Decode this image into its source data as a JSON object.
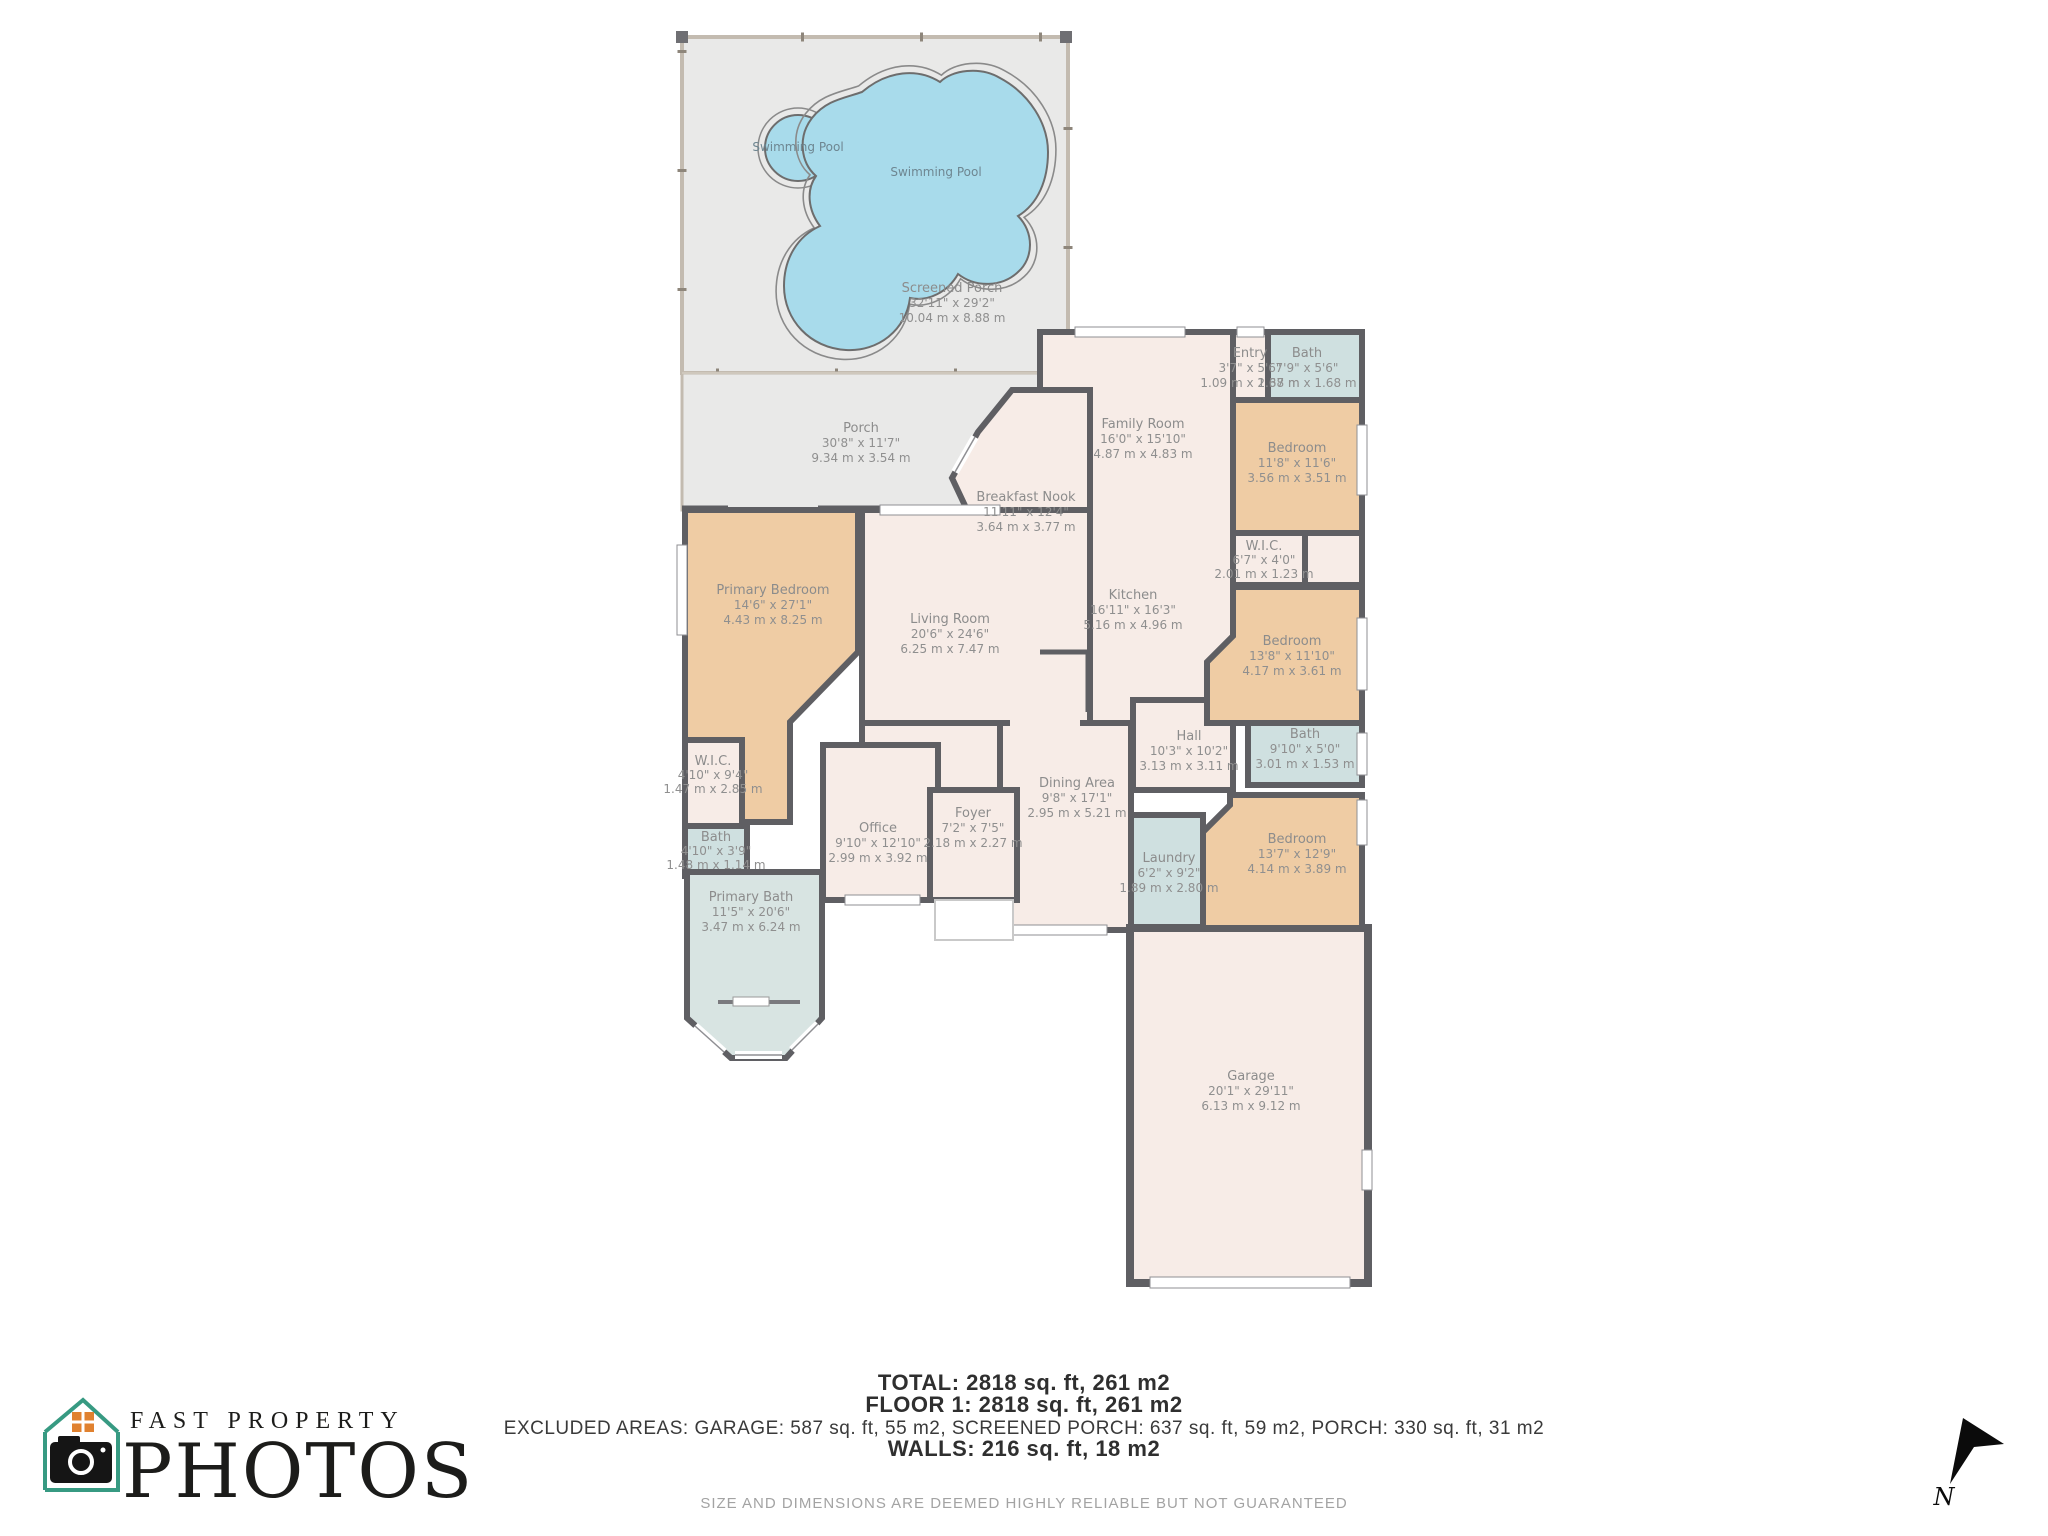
{
  "palette": {
    "wall": "#5f5f63",
    "room_cream": "#f7ece7",
    "room_tan": "#efcca4",
    "room_bath": "#cfe0e0",
    "room_bath_light": "#d8e4e2",
    "porch_gray": "#e9e9e8",
    "pool_blue": "#a8dbeb",
    "label_gray": "#8c8c8c",
    "logo_teal": "#379a82",
    "logo_orange": "#e0812f",
    "ink": "#1c1c1a"
  },
  "rooms": [
    {
      "id": "swimming-pool-small",
      "name": "Swimming Pool"
    },
    {
      "id": "swimming-pool-large",
      "name": "Swimming Pool"
    },
    {
      "id": "screened-porch",
      "name": "Screened Porch",
      "dims_ft": "32'11\" x 29'2\"",
      "dims_m": "10.04 m x 8.88 m"
    },
    {
      "id": "porch",
      "name": "Porch",
      "dims_ft": "30'8\" x 11'7\"",
      "dims_m": "9.34 m x 3.54 m"
    },
    {
      "id": "breakfast-nook",
      "name": "Breakfast Nook",
      "dims_ft": "11'11\" x 12'4\"",
      "dims_m": "3.64 m x 3.77 m"
    },
    {
      "id": "family-room",
      "name": "Family Room",
      "dims_ft": "16'0\" x 15'10\"",
      "dims_m": "4.87 m x 4.83 m"
    },
    {
      "id": "entry",
      "name": "Entry",
      "dims_ft": "3'7\" x 5'6\"",
      "dims_m": "1.09 m x 1.68 m"
    },
    {
      "id": "bath-entry",
      "name": "Bath",
      "dims_ft": "7'9\" x 5'6\"",
      "dims_m": "2.37 m x 1.68 m"
    },
    {
      "id": "bedroom-ne",
      "name": "Bedroom",
      "dims_ft": "11'8\" x 11'6\"",
      "dims_m": "3.56 m x 3.51 m"
    },
    {
      "id": "wic-right",
      "name": "W.I.C.",
      "dims_ft": "6'7\" x 4'0\"",
      "dims_m": "2.01 m x 1.23 m"
    },
    {
      "id": "kitchen",
      "name": "Kitchen",
      "dims_ft": "16'11\" x 16'3\"",
      "dims_m": "5.16 m x 4.96 m"
    },
    {
      "id": "bedroom-e",
      "name": "Bedroom",
      "dims_ft": "13'8\" x 11'10\"",
      "dims_m": "4.17 m x 3.61 m"
    },
    {
      "id": "primary-bedroom",
      "name": "Primary Bedroom",
      "dims_ft": "14'6\" x 27'1\"",
      "dims_m": "4.43 m x 8.25 m"
    },
    {
      "id": "living-room",
      "name": "Living Room",
      "dims_ft": "20'6\" x 24'6\"",
      "dims_m": "6.25 m x 7.47 m"
    },
    {
      "id": "hall",
      "name": "Hall",
      "dims_ft": "10'3\" x 10'2\"",
      "dims_m": "3.13 m x 3.11 m"
    },
    {
      "id": "bath-e",
      "name": "Bath",
      "dims_ft": "9'10\" x 5'0\"",
      "dims_m": "3.01 m x 1.53 m"
    },
    {
      "id": "wic-left",
      "name": "W.I.C.",
      "dims_ft": "4'10\" x 9'4\"",
      "dims_m": "1.47 m x 2.85 m"
    },
    {
      "id": "office",
      "name": "Office",
      "dims_ft": "9'10\" x 12'10\"",
      "dims_m": "2.99 m x 3.92 m"
    },
    {
      "id": "foyer",
      "name": "Foyer",
      "dims_ft": "7'2\" x 7'5\"",
      "dims_m": "2.18 m x 2.27 m"
    },
    {
      "id": "dining-area",
      "name": "Dining Area",
      "dims_ft": "9'8\" x 17'1\"",
      "dims_m": "2.95 m x 5.21 m"
    },
    {
      "id": "bath-left",
      "name": "Bath",
      "dims_ft": "4'10\" x 3'9\"",
      "dims_m": "1.48 m x 1.14 m"
    },
    {
      "id": "primary-bath",
      "name": "Primary Bath",
      "dims_ft": "11'5\" x 20'6\"",
      "dims_m": "3.47 m x 6.24 m"
    },
    {
      "id": "laundry",
      "name": "Laundry",
      "dims_ft": "6'2\" x 9'2\"",
      "dims_m": "1.89 m x 2.80 m"
    },
    {
      "id": "bedroom-se",
      "name": "Bedroom",
      "dims_ft": "13'7\" x 12'9\"",
      "dims_m": "4.14 m x 3.89 m"
    },
    {
      "id": "garage",
      "name": "Garage",
      "dims_ft": "20'1\" x 29'11\"",
      "dims_m": "6.13 m x 9.12 m"
    }
  ],
  "footer": {
    "total": "TOTAL: 2818 sq. ft, 261 m2",
    "floor": "FLOOR 1: 2818 sq. ft, 261 m2",
    "excluded": "EXCLUDED AREAS: GARAGE: 587 sq. ft, 55 m2, SCREENED PORCH: 637 sq. ft, 59 m2, PORCH: 330 sq. ft, 31 m2",
    "walls": "WALLS: 216 sq. ft, 18 m2",
    "disclaimer": "SIZE AND DIMENSIONS ARE DEEMED HIGHLY RELIABLE BUT NOT GUARANTEED"
  },
  "branding": {
    "line1": "FAST PROPERTY",
    "line2": "PHOTOS"
  },
  "compass": {
    "label": "N"
  }
}
